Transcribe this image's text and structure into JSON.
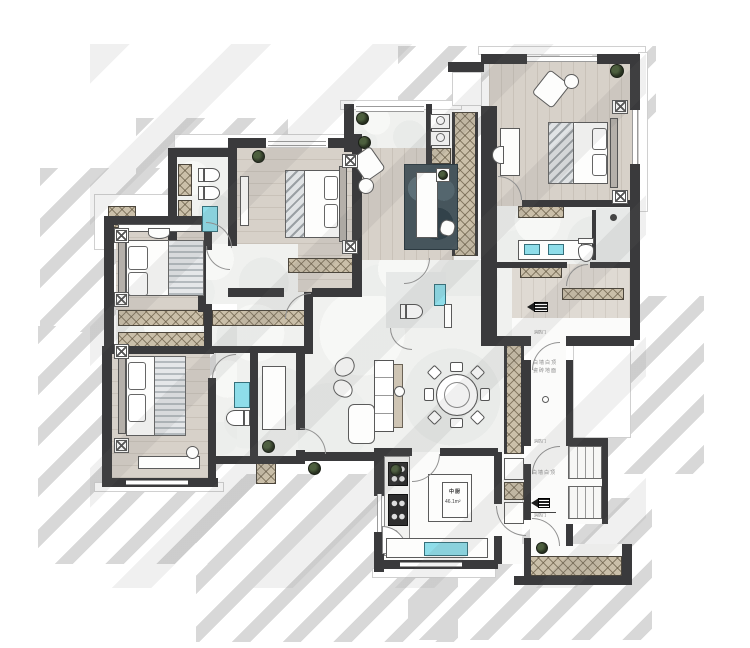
{
  "meta": {
    "type": "residential-floor-plan-render"
  },
  "labels": {
    "corridor_note_line1": "白墙白顶",
    "corridor_note_line2": "瓷砖地面",
    "stair_note": "白墙白顶",
    "kitchen_name": "中厨",
    "kitchen_area": "46.1m²",
    "fire_door": "消防门"
  },
  "colors": {
    "wall": "#3a3a3c",
    "wood": "#d7d1c9",
    "marble": "#f0f1ef",
    "hatch": "#cabfa9",
    "cyan": "#8edde9",
    "rug": "#46555c",
    "plant": "#27301f",
    "shadow": "#d8d8d8"
  },
  "icons": [
    "plant-icon",
    "lamp-icon",
    "stove-icon",
    "sink-icon",
    "toilet-icon",
    "entry-arrow-icon",
    "door-station-icon",
    "shower-icon"
  ]
}
